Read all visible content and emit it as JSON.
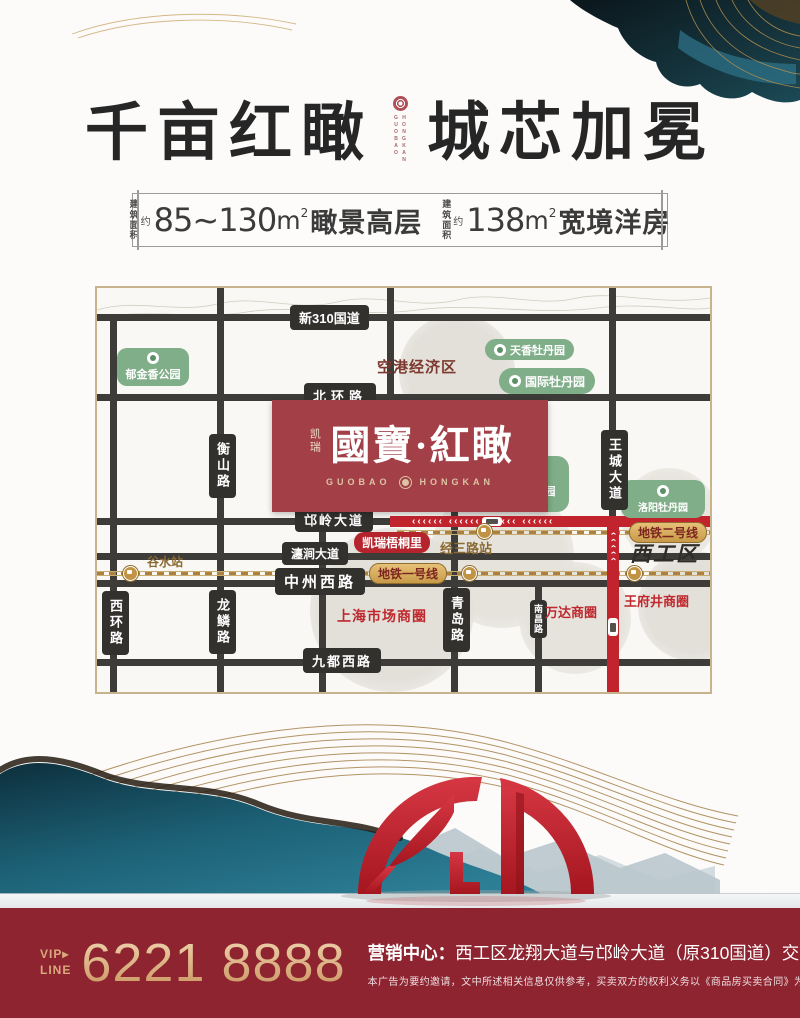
{
  "title": {
    "left": "千亩红瞰",
    "right": "城芯加冕",
    "latin1": "GUOBAO",
    "latin2": "HONGKAN"
  },
  "banner": {
    "items": [
      {
        "area1": "建筑",
        "area2": "面积",
        "approx": "约",
        "value": "85~130",
        "unit": "m",
        "power": "2",
        "desc": "瞰景高层"
      },
      {
        "area1": "建筑",
        "area2": "面积",
        "approx": "约",
        "value": "138",
        "unit": "m",
        "power": "2",
        "desc": "宽境洋房"
      }
    ]
  },
  "map": {
    "roads": {
      "g310": "新310国道",
      "beihuan": "北环路",
      "mangling": "邙岭大道",
      "chanjian": "瀍涧大道",
      "zhongzhou": "中州西路",
      "jiudu": "九都西路",
      "xihuan": "西环路",
      "hengshan": "衡山路",
      "longlin": "龙鳞路",
      "huashan": "华山路",
      "qingdao": "青岛路",
      "nanchang": "南昌路",
      "wangcheng": "王城大道"
    },
    "metro": {
      "line1": "地铁一号线",
      "line2": "地铁二号线",
      "station_gushui": "谷水站",
      "station_jingsan": "经三路站"
    },
    "parks": {
      "tulip": "郁金香公园",
      "tianxiang": "天香牡丹园",
      "intl": "国际牡丹园",
      "national": "国家牡丹园",
      "luoyang": "洛阳牡丹园"
    },
    "areas": {
      "airport": "空港经济区",
      "xigong": "西工区",
      "shanghai": "上海市场商圈",
      "wanda": "万达商圈",
      "wangfujing": "王府井商圈",
      "kairui_wutongli": "凯瑞梧桐里"
    },
    "project": {
      "brand": "凯瑞",
      "name": "國寶·紅瞰",
      "latin_left": "GUOBAO",
      "latin_right": "HONGKAN"
    },
    "decor": {
      "arrows_h": "‹‹‹‹‹‹      ‹‹‹‹‹‹      ‹‹‹‹‹‹      ‹‹‹‹‹‹",
      "arrows_v": "‹‹‹‹‹"
    }
  },
  "footer": {
    "vip": "VIP",
    "vip_arrow": "▸",
    "line": "LINE",
    "phone": "6221 8888",
    "center_label": "营销中心：",
    "center_text": "西工区龙翔大道与邙岭大道（原310国道）交会处",
    "disclaimer": "本广告为要约邀请，文中所述相关信息仅供参考，买卖双方的权利义务以《商品房买卖合同》为准。"
  },
  "colors": {
    "footer_bg": "#8d2430",
    "gold": "#d9a97d",
    "road_dark": "#3e3c39",
    "highway_red": "#c2242e",
    "park_green": "#7fae88",
    "project_red": "#a23f47"
  }
}
